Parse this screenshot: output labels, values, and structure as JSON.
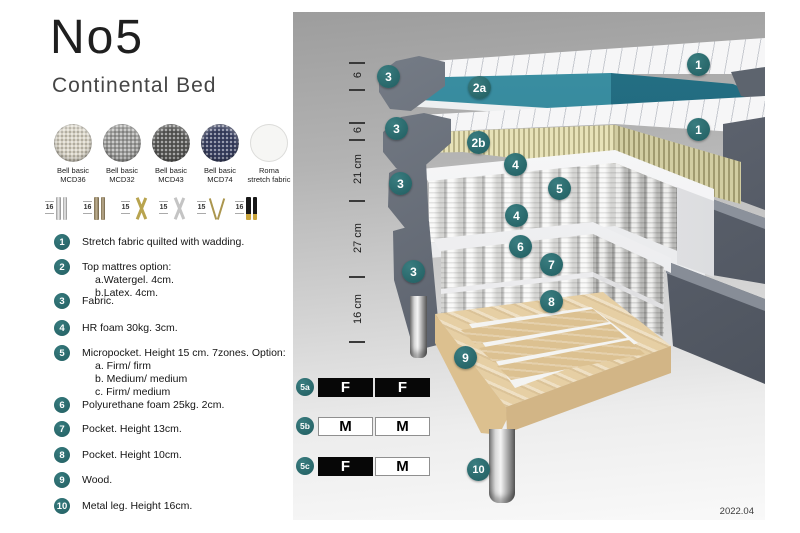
{
  "header": {
    "title": "No5",
    "subtitle": "Continental Bed"
  },
  "fabrics": [
    {
      "line1": "Bell basic",
      "line2": "MCD36",
      "color": "#d6d1c3"
    },
    {
      "line1": "Bell basic",
      "line2": "MCD32",
      "color": "#9c9c9a"
    },
    {
      "line1": "Bell basic",
      "line2": "MCD43",
      "color": "#5c5c5a"
    },
    {
      "line1": "Bell basic",
      "line2": "MCD74",
      "color": "#3c4364"
    },
    {
      "line1": "Roma",
      "line2": "stretch fabric",
      "color": "#f6f6f4"
    }
  ],
  "legs": [
    {
      "height": "16",
      "style": "chrome straight"
    },
    {
      "height": "16",
      "style": "bronze straight"
    },
    {
      "height": "15",
      "style": "gold cross"
    },
    {
      "height": "15",
      "style": "silver cross"
    },
    {
      "height": "15",
      "style": "gold hairpin"
    },
    {
      "height": "16",
      "style": "black with gold tip"
    }
  ],
  "features": [
    {
      "num": "1",
      "text": "Stretch fabric quilted with wadding.",
      "subs": []
    },
    {
      "num": "2",
      "text": "Top mattres option:",
      "subs": [
        "a.Watergel. 4cm.",
        "b.Latex. 4cm."
      ]
    },
    {
      "num": "3",
      "text": "Fabric.",
      "subs": []
    },
    {
      "num": "4",
      "text": "HR foam 30kg. 3cm.",
      "subs": []
    },
    {
      "num": "5",
      "text": "Micropocket. Height 15 cm. 7zones. Option:",
      "subs": [
        "a. Firm/ firm",
        "b. Medium/ medium",
        "c. Firm/ medium"
      ]
    },
    {
      "num": "6",
      "text": "Polyurethane foam 25kg. 2cm.",
      "subs": []
    },
    {
      "num": "7",
      "text": "Pocket. Height 13cm.",
      "subs": []
    },
    {
      "num": "8",
      "text": "Pocket. Height 10cm.",
      "subs": []
    },
    {
      "num": "9",
      "text": "Wood.",
      "subs": []
    },
    {
      "num": "10",
      "text": "Metal leg. Height 16cm.",
      "subs": []
    }
  ],
  "diagram": {
    "measurements": [
      "6",
      "6",
      "21 cm",
      "27 cm",
      "16 cm"
    ],
    "badges": [
      "3",
      "2a",
      "1",
      "3",
      "2b",
      "1",
      "4",
      "3",
      "5",
      "4",
      "6",
      "3",
      "7",
      "8",
      "9",
      "10"
    ],
    "firmness": [
      {
        "id": "5a",
        "left": "F",
        "right": "F",
        "left_dark": true,
        "right_dark": true
      },
      {
        "id": "5b",
        "left": "M",
        "right": "M",
        "left_dark": false,
        "right_dark": false
      },
      {
        "id": "5c",
        "left": "F",
        "right": "M",
        "left_dark": true,
        "right_dark": false
      }
    ],
    "version": "2022.04"
  },
  "colors": {
    "accent_teal": "#2c6e71",
    "gel_teal": "#2d7e92",
    "latex_yellow": "#d8d3a6",
    "wood": "#e6cfa4",
    "fabric_gray": "#5d636e",
    "firm_dark": "#070707"
  }
}
